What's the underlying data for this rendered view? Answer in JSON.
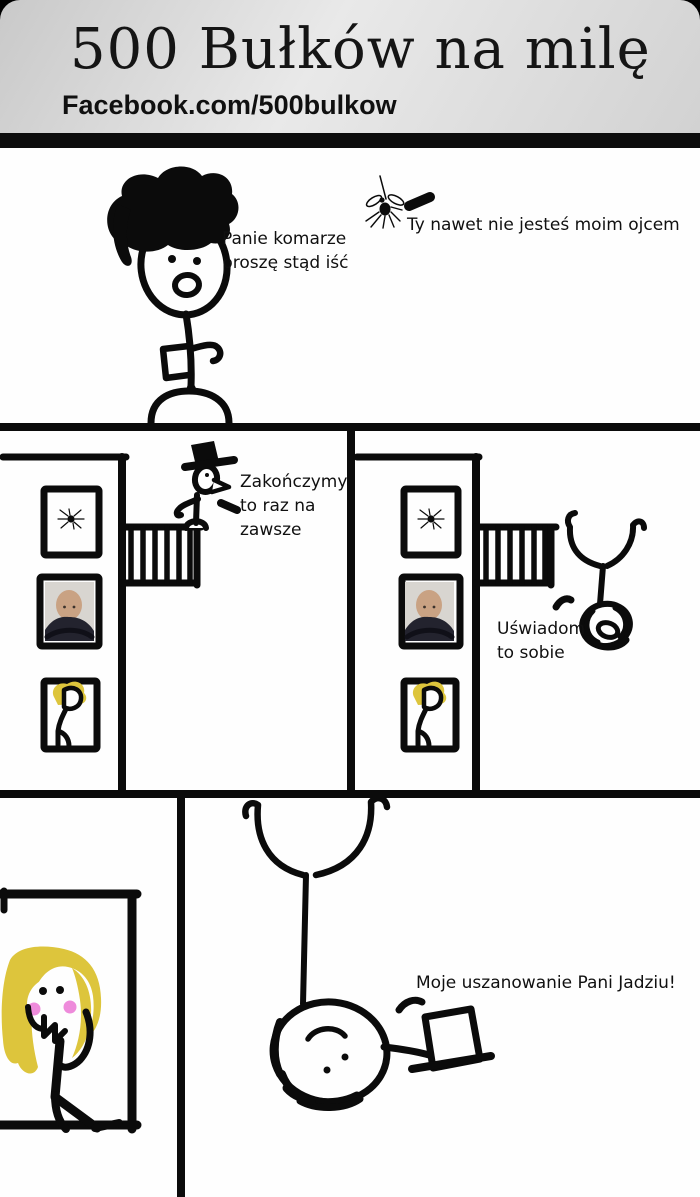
{
  "header": {
    "title": "500 Bułków na milę",
    "subtitle": "Facebook.com/500bulkow"
  },
  "panel1": {
    "man_speech": "Panie komarze proszę stąd iść",
    "mosquito_speech": "Ty nawet nie jesteś moim ojcem",
    "figures": [
      "stick man with messy black hair",
      "mosquito"
    ]
  },
  "panel2": {
    "hat_man_speech": "Zakończymy to raz na zawsze",
    "falling_man_speech": "Uświadom to sobie",
    "figures": [
      "man with hat standing on balcony",
      "man falling upside down"
    ],
    "window_contents": [
      "spider",
      "Putin photo",
      "blonde woman"
    ]
  },
  "panel3": {
    "hat_man_speech": "Moje uszanowanie Pani Jadziu!",
    "figures": [
      "blonde woman at window",
      "man hanging upside down tipping his top hat"
    ]
  },
  "colors": {
    "paper": "#fefefe",
    "ink": "#0b0b0b",
    "header_from": "#c9c9c9",
    "header_to": "#e9e9e9",
    "header_bar": "#0d0d0d",
    "hair_yellow": "#ddc53c",
    "blush_pink": "#ee8bdb",
    "photo_bg": "#d8d5d0",
    "photo_skin": "#c9a283",
    "photo_clothes": "#23232e"
  }
}
